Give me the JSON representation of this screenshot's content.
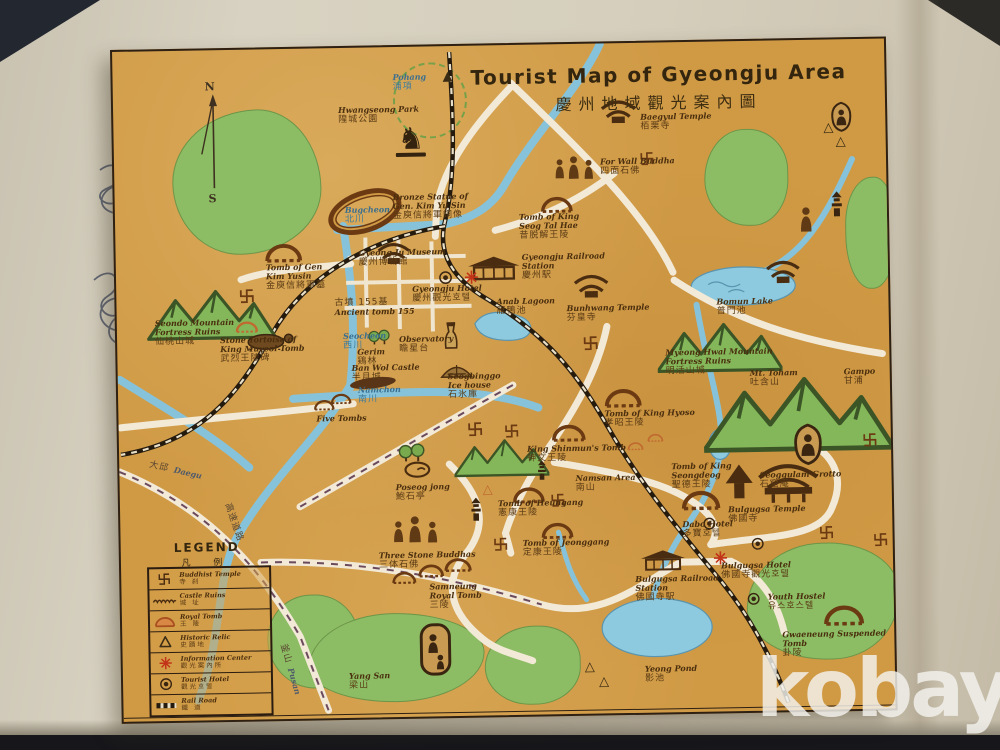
{
  "watermark": "kobay",
  "colors": {
    "paper": "#d09a45",
    "hill": "#8cbd64",
    "water": "#86c3db",
    "road": "#f2e9d6",
    "rail": "#241a0e",
    "ink": "#4a2e0e",
    "accent_red": "#c23318"
  },
  "map": {
    "title_en": "Tourist Map of Gyeongju Area",
    "title_cjk": "慶州地域觀光案內圖",
    "compass": {
      "north": "N",
      "south": "S"
    },
    "legend": {
      "title": "LEGEND",
      "title_cjk": "凡 例",
      "items": [
        {
          "icon": "manji",
          "en": "Buddhist Temple",
          "cjk": "寺 刹"
        },
        {
          "icon": "wave",
          "en": "Castle Ruins",
          "cjk": "城 址"
        },
        {
          "icon": "dome",
          "en": "Royal Tomb",
          "cjk": "王 陵"
        },
        {
          "icon": "triangle",
          "en": "Historic Relic",
          "cjk": "史蹟地"
        },
        {
          "icon": "asterisk",
          "en": "Information Center",
          "cjk": "觀光案內所"
        },
        {
          "icon": "double-circle",
          "en": "Tourist Hotel",
          "cjk": "觀光호텔"
        },
        {
          "icon": "rail-bar",
          "en": "Rail Road",
          "cjk": "鐵 道"
        }
      ]
    },
    "pois": {
      "pohang": {
        "en": "Pohang",
        "cjk": "浦項"
      },
      "hwangseong_park": {
        "en": "Hwangseong Park",
        "cjk": "隍城公園"
      },
      "bronze_statue": {
        "en": "Bronze Statue of\nGen. Kim Yu Sin",
        "cjk": "金庾信將軍銅像"
      },
      "bugcheon": {
        "en": "Bugcheon",
        "cjk": "北川"
      },
      "tomb_gen_kim_yusin": {
        "en": "Tomb of Gen\nKim Yusin",
        "cjk": "金庾信將軍墓"
      },
      "seondo": {
        "en": "Seondo Mountain\nFortress Ruins",
        "cjk": "仙桃山城"
      },
      "stone_tortoise": {
        "en": "Stone Tortoise of\nKing Muyeol Tomb",
        "cjk": "武烈王陵碑"
      },
      "gyeongju_museum": {
        "en": "Gyeong Ju Museum",
        "cjk": "慶州博物館"
      },
      "gyeongju_hotel": {
        "en": "Gyeongju Hotel",
        "cjk": "慶州觀光호텔"
      },
      "ancient_tomb": {
        "en": "Ancient tomb 155",
        "cjk": "古墳 155基"
      },
      "gyeongju_station": {
        "en": "Gyeongju Railroad\nStation",
        "cjk": "慶州駅"
      },
      "anab_lagoon": {
        "en": "Anab Lagoon",
        "cjk": "雁鴨池"
      },
      "bunhwang_temple": {
        "en": "Bunhwang Temple",
        "cjk": "芬皇寺"
      },
      "baegyul_temple": {
        "en": "Baegyul Temple",
        "cjk": "栢栗寺"
      },
      "for_wall_buddha": {
        "en": "For Wall Buddha",
        "cjk": "四面石佛"
      },
      "seog_tal_hae": {
        "en": "Tomb of King\nSeog Tal Hae",
        "cjk": "昔脱解王陵"
      },
      "bomun_lake": {
        "en": "Bomun Lake",
        "cjk": "普門池"
      },
      "myeonghwal": {
        "en": "Myeong Hwal Mountain\nFortress Ruins",
        "cjk": "明活山城"
      },
      "mt_toham": {
        "en": "Mt. Toham",
        "cjk": "吐含山"
      },
      "gampo": {
        "en": "Gampo",
        "cjk": "甘浦"
      },
      "seocheon": {
        "en": "Seocheon",
        "cjk": "西川"
      },
      "gerim": {
        "en": "Gerim",
        "cjk": "鶏林"
      },
      "observatory": {
        "en": "Observatory",
        "cjk": "瞻星台"
      },
      "banwol": {
        "en": "Ban Wol Castle",
        "cjk": "半月城"
      },
      "seogbinggo": {
        "en": "Seogbinggo\nIce house",
        "cjk": "石氷庫"
      },
      "namchon": {
        "en": "Namchon",
        "cjk": "南川"
      },
      "five_tombs": {
        "en": "Five Tombs",
        "cjk": "五陵"
      },
      "daegu": {
        "en": "Daegu",
        "cjk": "大邱"
      },
      "expressway": {
        "cjk": "高速道路"
      },
      "pusan": {
        "en": "Pusan",
        "cjk": "釜山"
      },
      "poseokjong": {
        "en": "Poseog jong",
        "cjk": "鮑石亭"
      },
      "king_shinmun": {
        "en": "King Shinmun's Tomb",
        "cjk": "神文王陵"
      },
      "tomb_hyoso": {
        "en": "Tomb of King Hyoso",
        "cjk": "孝昭王陵"
      },
      "namsan": {
        "en": "Namsan Area",
        "cjk": "南山"
      },
      "tomb_seongdeog": {
        "en": "Tomb of King\nSeongdeog",
        "cjk": "聖德王陵"
      },
      "tomb_heungang": {
        "en": "Tomb of Heungang",
        "cjk": "憲康王陵"
      },
      "tomb_jeonggang": {
        "en": "Tomb of Jeonggang",
        "cjk": "定康王陵"
      },
      "three_buddhas": {
        "en": "Three Stone Buddhas",
        "cjk": "三体石佛"
      },
      "samneung": {
        "en": "Samneung\nRoyal Tomb",
        "cjk": "三陵"
      },
      "yangsan": {
        "en": "Yang San",
        "cjk": "梁山"
      },
      "seokguram": {
        "en": "Seoggulam Grotto",
        "cjk": "石窟庵"
      },
      "bulguksa_temple": {
        "en": "Bulgugsa Temple",
        "cjk": "佛國寺"
      },
      "dabo_hotel": {
        "en": "Dabo Hotel",
        "cjk": "多寶호텔"
      },
      "bulguksa_hotel": {
        "en": "Bulgugsa Hotel",
        "cjk": "佛國寺觀光호텔"
      },
      "bulguksa_station": {
        "en": "Bulgugsa Railroad\nStation",
        "cjk": "佛國寺駅"
      },
      "yeong_pond": {
        "en": "Yeong Pond",
        "cjk": "影池"
      },
      "youth_hostel": {
        "en": "Youth Hostel",
        "cjk": "유스호스텔"
      },
      "gwaeneung": {
        "en": "Gwaeneung Suspended Tomb",
        "cjk": "卦陵"
      }
    }
  }
}
